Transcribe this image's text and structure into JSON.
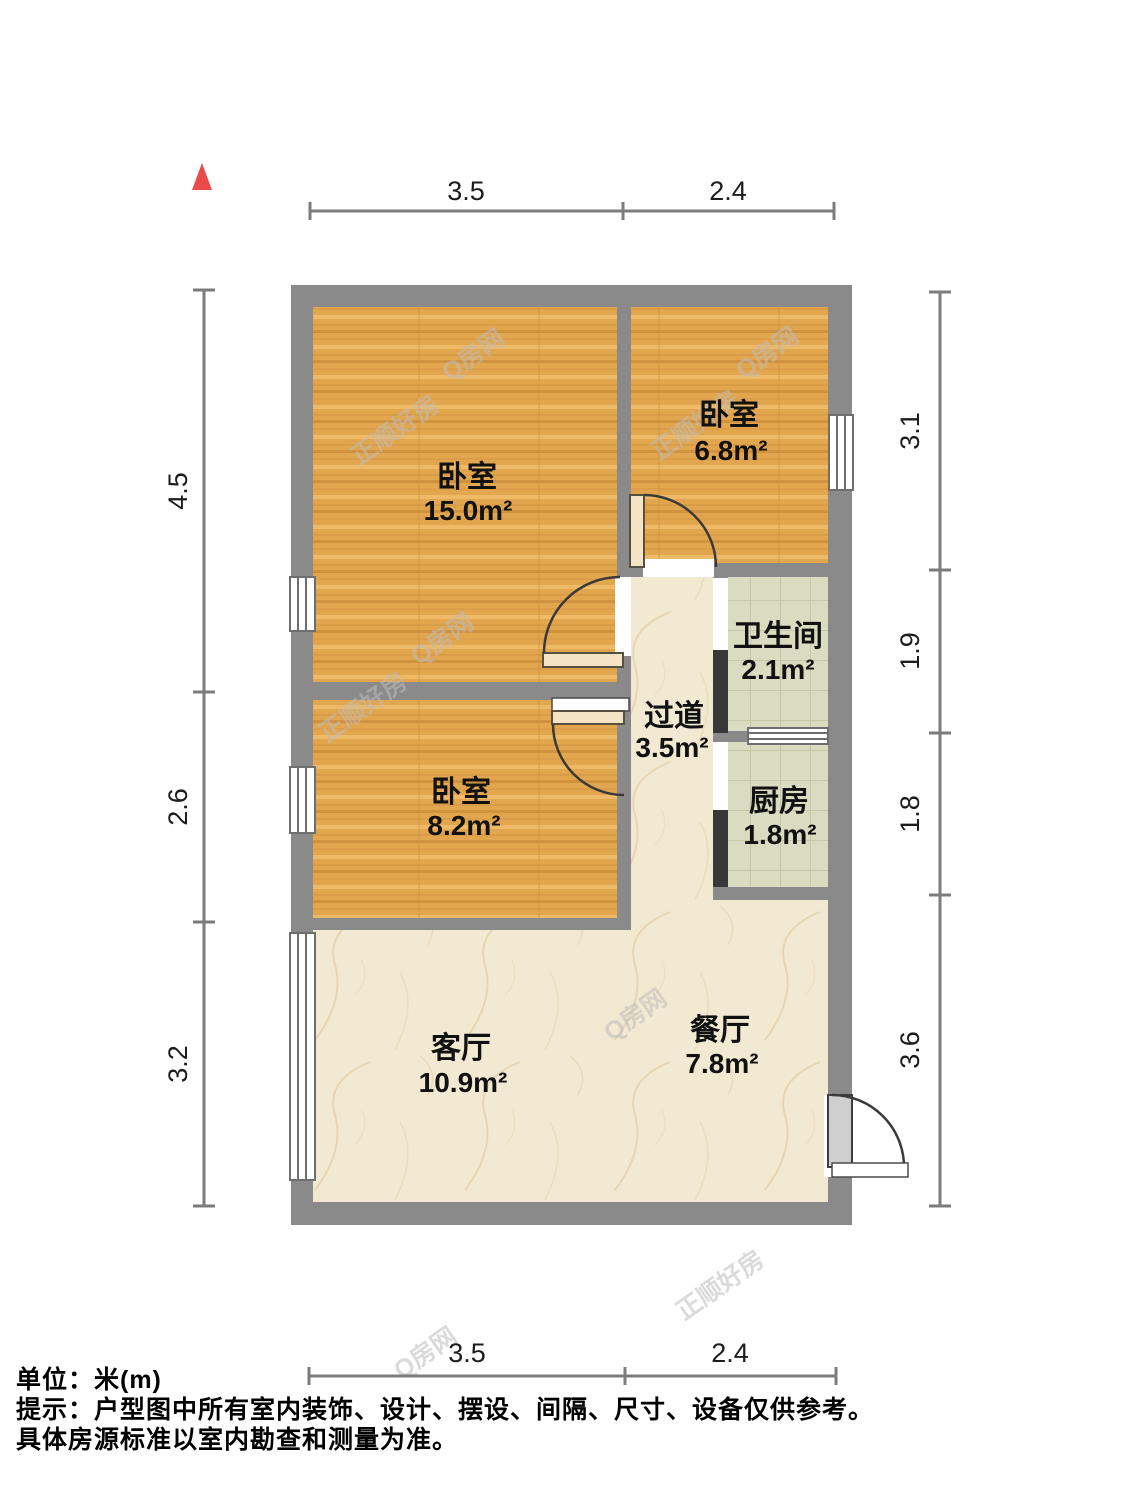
{
  "north_arrow": {
    "icon": "north-triangle"
  },
  "dimensions": {
    "top": [
      "3.5",
      "2.4"
    ],
    "bottom": [
      "3.5",
      "2.4"
    ],
    "left": [
      "4.5",
      "2.6",
      "3.2"
    ],
    "right": [
      "3.1",
      "1.9",
      "1.8",
      "3.6"
    ]
  },
  "rooms": [
    {
      "id": "bedroom-main",
      "name": "卧室",
      "area": "15.0m²"
    },
    {
      "id": "bedroom-top-right",
      "name": "卧室",
      "area": "6.8m²"
    },
    {
      "id": "bathroom",
      "name": "卫生间",
      "area": "2.1m²"
    },
    {
      "id": "hallway",
      "name": "过道",
      "area": "3.5m²"
    },
    {
      "id": "kitchen",
      "name": "厨房",
      "area": "1.8m²"
    },
    {
      "id": "bedroom-middle",
      "name": "卧室",
      "area": "8.2m²"
    },
    {
      "id": "living-room",
      "name": "客厅",
      "area": "10.9m²"
    },
    {
      "id": "dining-room",
      "name": "餐厅",
      "area": "7.8m²"
    }
  ],
  "watermarks": [
    {
      "text": "正顺好房"
    },
    {
      "text": "Q房网"
    },
    {
      "text": "正顺好房"
    },
    {
      "text": "Q房网"
    },
    {
      "text": "正顺好房"
    },
    {
      "text": "Q房网"
    },
    {
      "text": "Q房网"
    },
    {
      "text": "正顺好房"
    },
    {
      "text": "Q房网"
    }
  ],
  "footer": {
    "line1": "单位：米(m)",
    "line2": "提示：户型图中所有室内装饰、设计、摆设、间隔、尺寸、设备仅供参考。",
    "line3": "具体房源标准以室内勘查和测量为准。"
  },
  "colors": {
    "north": "#ea4a4a",
    "wall": "#8a8a8a",
    "wall-dark": "#383838",
    "dim": "#7c7c7c",
    "wood": "#e2a64e",
    "tile": "#dadcc2",
    "marble": "#f2e9d3",
    "watermark": "#bdbdbd"
  }
}
